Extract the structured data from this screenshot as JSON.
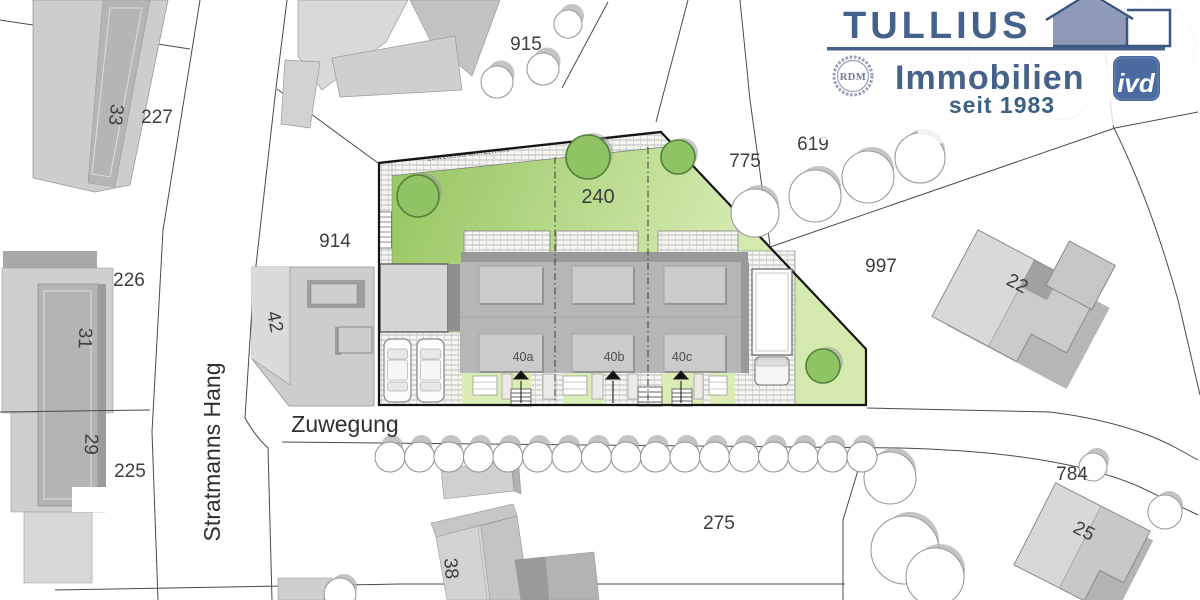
{
  "logo": {
    "brand": "TULLIUS",
    "line2": "Immobilien",
    "since": "seit 1983",
    "seal": "RDM",
    "badge": "ivd"
  },
  "streets": {
    "vertical": "Stratmanns Hang",
    "horizontal": "Zuwegung"
  },
  "site": {
    "plot_number": "240",
    "access_path_label": "ZUWEGUNG MITTELHAUS",
    "house_numbers": [
      "40a",
      "40b",
      "40c"
    ]
  },
  "parcels": {
    "p33": "33",
    "p227": "227",
    "p915": "915",
    "p775": "775",
    "p619": "619",
    "p997": "997",
    "p226": "226",
    "p31": "31",
    "p42": "42",
    "p914": "914",
    "p29": "29",
    "p225": "225",
    "p22": "22",
    "p784": "784",
    "p275": "275",
    "p38": "38",
    "p25": "25"
  },
  "colors": {
    "lawn_dark": "#9cc968",
    "lawn_light": "#d3e9ad",
    "front_garden": "#dcecb6",
    "tree_green": "#8fc464",
    "logo_blue": "#45618c",
    "badge_blue": "#4a6b9f",
    "building_gray": "#cdcdcd",
    "house_body_gray": "#b6b6b6"
  }
}
